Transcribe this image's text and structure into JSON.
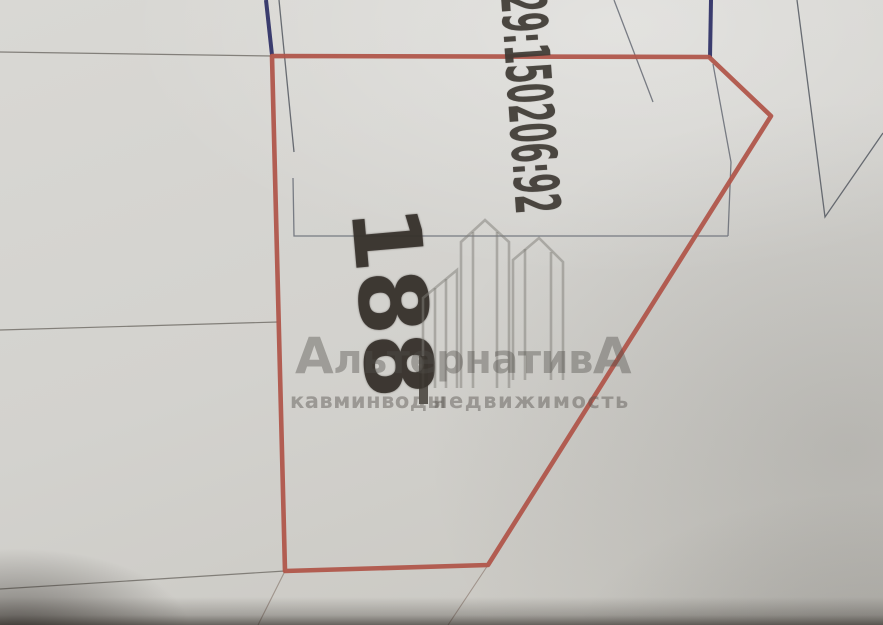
{
  "map": {
    "plot_number": "188",
    "cadastral_number": "29:150206:92",
    "colors": {
      "paper": "#d2d1cd",
      "plot_boundary_red": "#b0564b",
      "reference_line_blue": "#3a3c6e",
      "parcel_line_gray": "#6d717a",
      "stamp_ink": "#3a352f"
    }
  },
  "watermark": {
    "brand_initial": "А",
    "brand_middle": "льтернатив",
    "brand_final": "А",
    "tagline_left": "кавминводы",
    "tagline_right": "недвижимость",
    "logo_icon": "houses-outline-icon",
    "color": "#8a8782"
  }
}
